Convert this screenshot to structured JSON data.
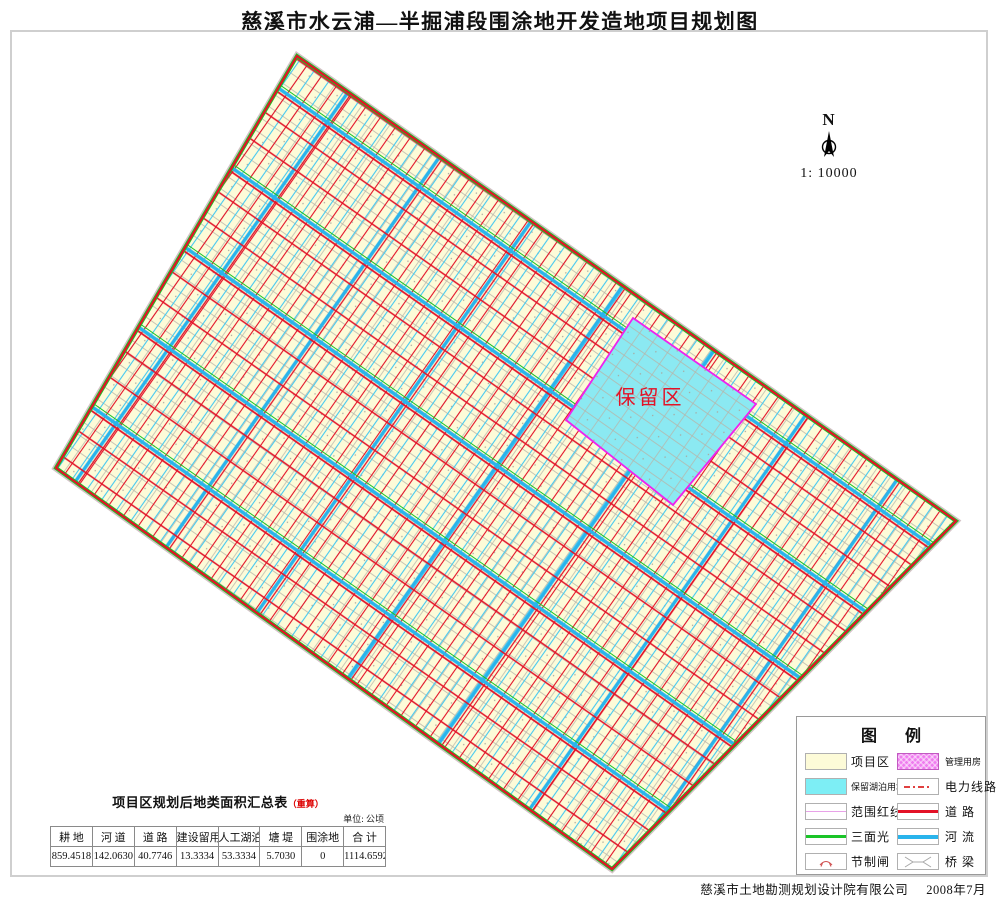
{
  "title": "慈溪市水云浦—半掘浦段围涂地开发造地项目规划图",
  "map": {
    "reserved_area_label": "保留区",
    "north_label": "N",
    "scale_label": "1: 10000"
  },
  "legend": {
    "title": "图       例",
    "items_left": [
      {
        "label": "项目区",
        "symbol": "project-area-swatch"
      },
      {
        "label": "保留湖泊用地",
        "symbol": "reserved-lake-swatch"
      },
      {
        "label": "范围红线",
        "symbol": "boundary-redline-symbol"
      },
      {
        "label": "三面光",
        "symbol": "lined-channel-symbol"
      },
      {
        "label": "节制闸",
        "symbol": "control-gate-icon"
      }
    ],
    "items_right": [
      {
        "label": "管理用房",
        "symbol": "management-housing-swatch"
      },
      {
        "label": "电力线路",
        "symbol": "power-line-symbol"
      },
      {
        "label": "道 路",
        "symbol": "road-line-symbol"
      },
      {
        "label": "河 流",
        "symbol": "river-line-symbol"
      },
      {
        "label": "桥 梁",
        "symbol": "bridge-icon"
      }
    ]
  },
  "table": {
    "title": "项目区规划后地类面积汇总表",
    "title_note": "（重算）",
    "unit": "单位: 公顷",
    "headers": [
      "耕 地",
      "河 道",
      "道 路",
      "建设留用地",
      "人工湖泊",
      "塘 堤",
      "围涂地",
      "合 计"
    ],
    "values": [
      "859.4518",
      "142.0630",
      "40.7746",
      "13.3334",
      "53.3334",
      "5.7030",
      "0",
      "1114.6592"
    ]
  },
  "footer": {
    "company": "慈溪市土地勘测规划设计院有限公司",
    "date": "2008年7月"
  },
  "colors": {
    "parcel_cream": "#FDFBD8",
    "road_red": "#E31227",
    "river_cyan": "#29B4EC",
    "strip_cyan": "#45C8F0",
    "channel_green": "#1AC428",
    "reserved_fill": "#8BE9F2",
    "reserved_border_magenta": "#EE22EE",
    "management_pink": "#EF7BEF",
    "terrain_gray": "#B8B4A8"
  }
}
